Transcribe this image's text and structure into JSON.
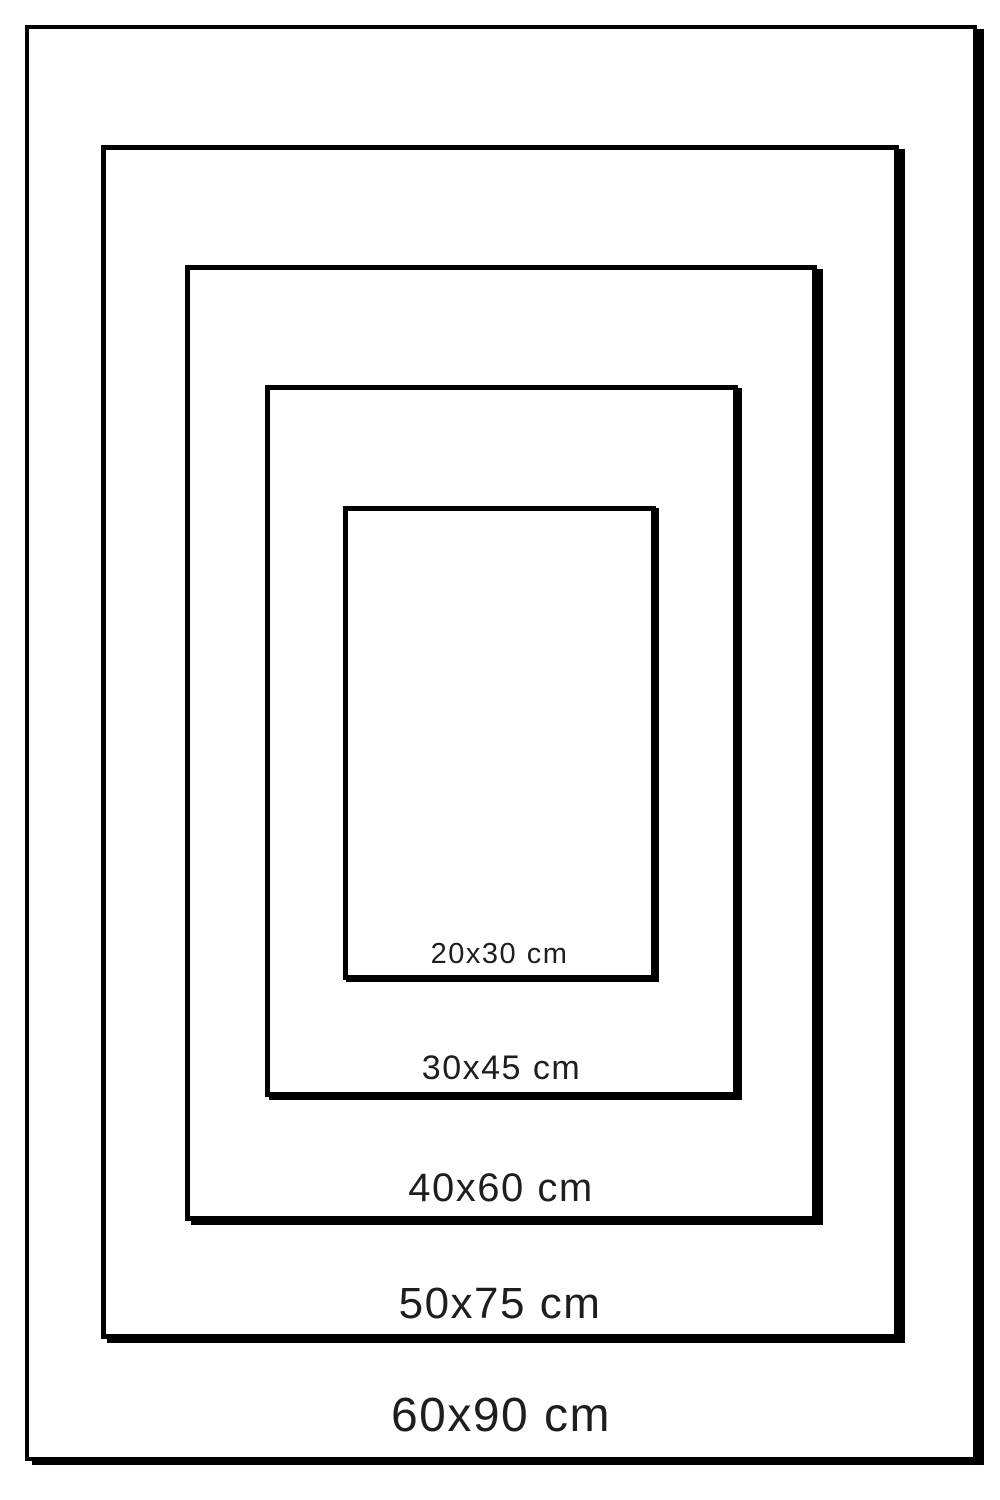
{
  "diagram": {
    "type": "nested-size-comparison",
    "unit": "cm",
    "frames": [
      {
        "name": "60x90",
        "label": "60x90 cm",
        "width_cm": 60,
        "height_cm": 90
      },
      {
        "name": "50x75",
        "label": "50x75 cm",
        "width_cm": 50,
        "height_cm": 75
      },
      {
        "name": "40x60",
        "label": "40x60 cm",
        "width_cm": 40,
        "height_cm": 60
      },
      {
        "name": "30x45",
        "label": "30x45 cm",
        "width_cm": 30,
        "height_cm": 45
      },
      {
        "name": "20x30",
        "label": "20x30 cm",
        "width_cm": 20,
        "height_cm": 30
      }
    ],
    "colors": {
      "border": "#000000",
      "background": "#ffffff",
      "text": "#1e1e1e"
    }
  }
}
